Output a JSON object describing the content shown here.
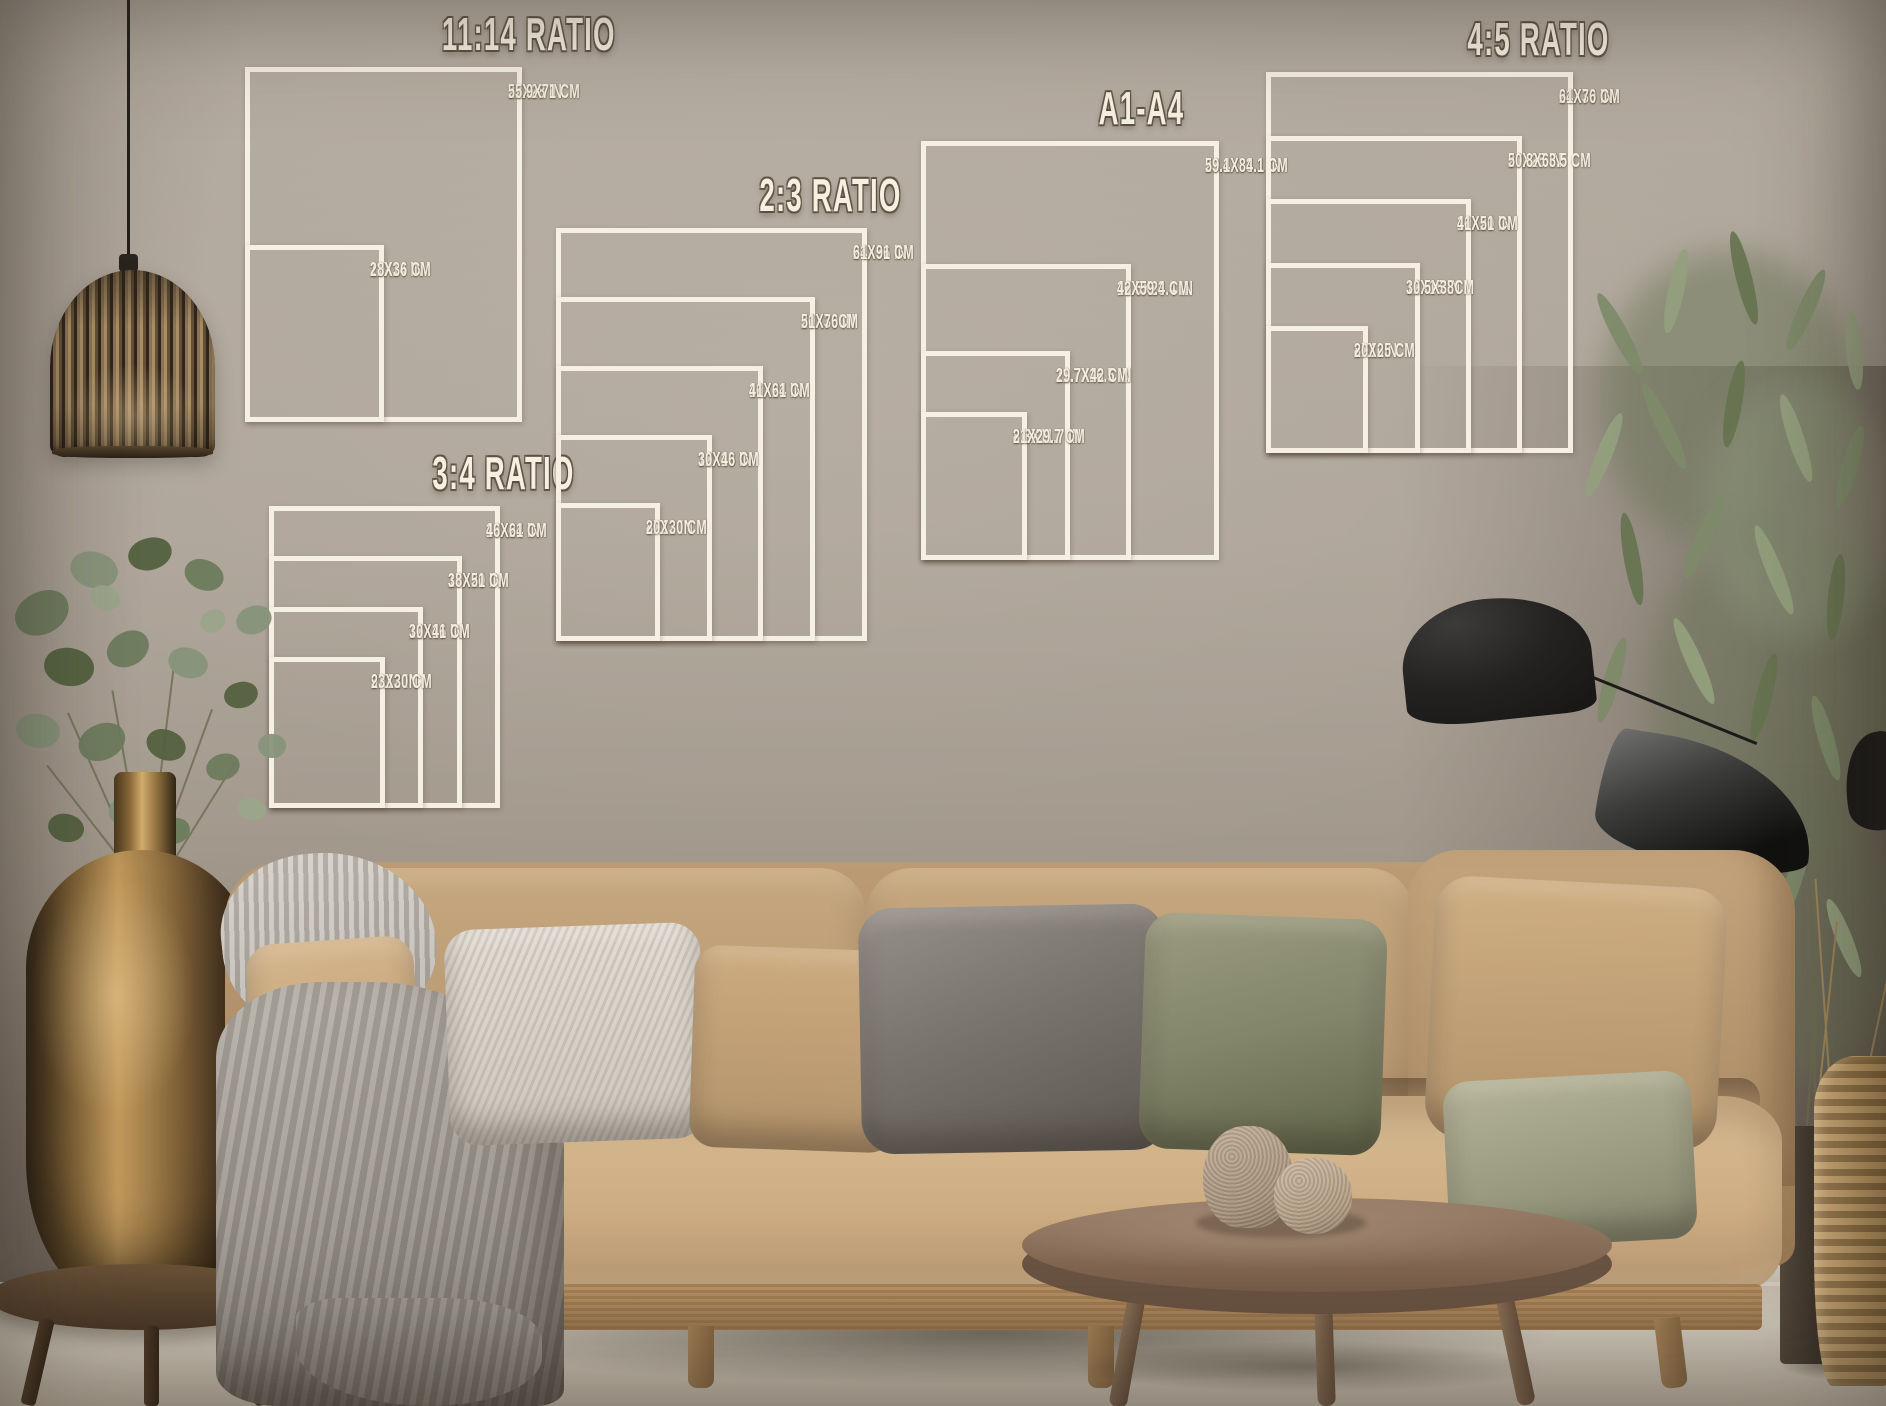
{
  "scene": {
    "setting": "living room wall with framed print size guide overlays",
    "wall_color": "#a89e93",
    "floor_color": "#d6cdbf",
    "sofa_color": "#c0a078",
    "chart_line_color": "#f6efe3",
    "chart_text_color": "#f4eddf",
    "objects": [
      "pendant-lamp",
      "eucalyptus-plant",
      "brass-vase",
      "wooden-stool",
      "sofa",
      "knit-throw",
      "pillows",
      "coffee-table",
      "ceramic-vases",
      "floor-lamp",
      "tall-plant",
      "dark-planter",
      "rattan-basket"
    ]
  },
  "charts": [
    {
      "id": "ratio-11-14",
      "title": "11:14 RATIO",
      "sizes": [
        {
          "label_in": "22X28 IN",
          "label_cm": "55.9X71 CM",
          "w": 22,
          "h": 28
        },
        {
          "label_in": "11X14 IN",
          "label_cm": "28X36 CM",
          "w": 11,
          "h": 14
        }
      ]
    },
    {
      "id": "ratio-3-4",
      "title": "3:4 RATIO",
      "sizes": [
        {
          "label_in": "18X24 IN",
          "label_cm": "46X61 CM",
          "w": 18,
          "h": 24
        },
        {
          "label_in": "15X20 IN",
          "label_cm": "38X51 CM",
          "w": 15,
          "h": 20
        },
        {
          "label_in": "12X16 IN",
          "label_cm": "30X41 CM",
          "w": 12,
          "h": 16
        },
        {
          "label_in": "9X12 IN",
          "label_cm": "23X30 CM",
          "w": 9,
          "h": 12
        }
      ]
    },
    {
      "id": "ratio-2-3",
      "title": "2:3 RATIO",
      "sizes": [
        {
          "label_in": "24X36 IN",
          "label_cm": "61X91 CM",
          "w": 24,
          "h": 36
        },
        {
          "label_in": "20X30 IN",
          "label_cm": "51X76CM",
          "w": 20,
          "h": 30
        },
        {
          "label_in": "16X24 IN",
          "label_cm": "41X61 CM",
          "w": 16,
          "h": 24
        },
        {
          "label_in": "12X18 IN",
          "label_cm": "30X46 CM",
          "w": 12,
          "h": 18
        },
        {
          "label_in": "8X12 IN",
          "label_cm": "20X30 CM",
          "w": 8,
          "h": 12
        }
      ]
    },
    {
      "id": "a1-a4",
      "title": "A1-A4",
      "sizes": [
        {
          "label_in": "23.4X33.1 IN",
          "label_cm": "59.1X84.1 CM",
          "w": 23.4,
          "h": 33.1
        },
        {
          "label_in": "16.5X23.4 IN",
          "label_cm": "42X59.4 CM",
          "w": 16.5,
          "h": 23.4
        },
        {
          "label_in": "11.7X16.5 IN",
          "label_cm": "29.7X42 CM",
          "w": 11.7,
          "h": 16.5
        },
        {
          "label_in": "8.3X11.7 IN",
          "label_cm": "21X29.7 CM",
          "w": 8.3,
          "h": 11.7
        }
      ]
    },
    {
      "id": "ratio-4-5",
      "title": "4:5 RATIO",
      "sizes": [
        {
          "label_in": "24X30 IN",
          "label_cm": "61X76 CM",
          "w": 24,
          "h": 30
        },
        {
          "label_in": "20X25 IN",
          "label_cm": "50.8X63.5 CM",
          "w": 20,
          "h": 25
        },
        {
          "label_in": "16X20 IN",
          "label_cm": "41X51 CM",
          "w": 16,
          "h": 20
        },
        {
          "label_in": "12X15 IN",
          "label_cm": "30.5X38CM",
          "w": 12,
          "h": 15
        },
        {
          "label_in": "8X10IN",
          "label_cm": "20X25 CM",
          "w": 8,
          "h": 10
        }
      ]
    }
  ]
}
